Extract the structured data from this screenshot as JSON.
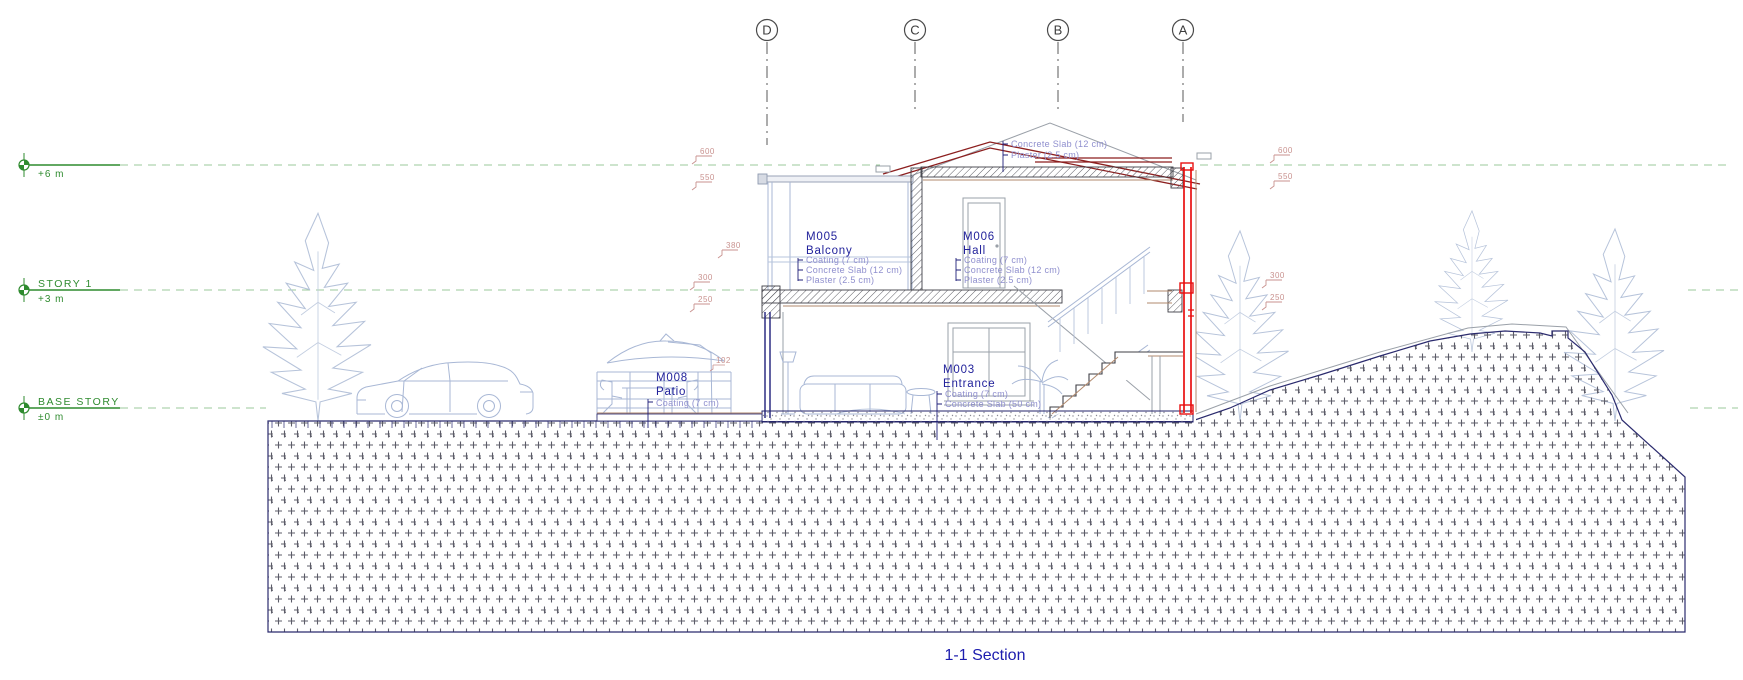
{
  "drawing": {
    "title": "1-1 Section",
    "grid_axes": [
      "D",
      "C",
      "B",
      "A"
    ],
    "levels": [
      {
        "name": "",
        "elev": "+6 m"
      },
      {
        "name": "STORY 1",
        "elev": "+3 m"
      },
      {
        "name": "BASE STORY",
        "elev": "±0 m"
      }
    ],
    "rooms": {
      "balcony": {
        "id": "M005",
        "name": "Balcony",
        "layers": [
          "Coating (7 cm)",
          "Concrete Slab (12 cm)",
          "Plaster (2.5 cm)"
        ]
      },
      "hall": {
        "id": "M006",
        "name": "Hall",
        "layers": [
          "Coating (7 cm)",
          "Concrete Slab (12 cm)",
          "Plaster (2.5 cm)"
        ]
      },
      "entrance": {
        "id": "M003",
        "name": "Entrance",
        "layers": [
          "Coating (7 cm)",
          "Concrete Slab (50 cm)"
        ]
      },
      "patio": {
        "id": "M008",
        "name": "Patio",
        "layers": [
          "Coating (7 cm)"
        ]
      }
    },
    "roof_layers": [
      "Concrete Slab (12 cm)",
      "Plaster (2.5 cm)"
    ],
    "spot_elevations": {
      "left": [
        "600",
        "550",
        "380",
        "300",
        "250",
        "102"
      ],
      "right": [
        "600",
        "550",
        "300",
        "250"
      ]
    },
    "colors": {
      "selection_red": "#e81010",
      "roof_dark_red": "#8c1f1f",
      "annotation_green": "#2f8b2f",
      "label_navy": "#22229b",
      "layer_text": "#8f8fce",
      "spot_elevation": "#c9928f",
      "cad_light_blue": "#a8b7d5",
      "title_blue": "#1c1cae"
    }
  }
}
